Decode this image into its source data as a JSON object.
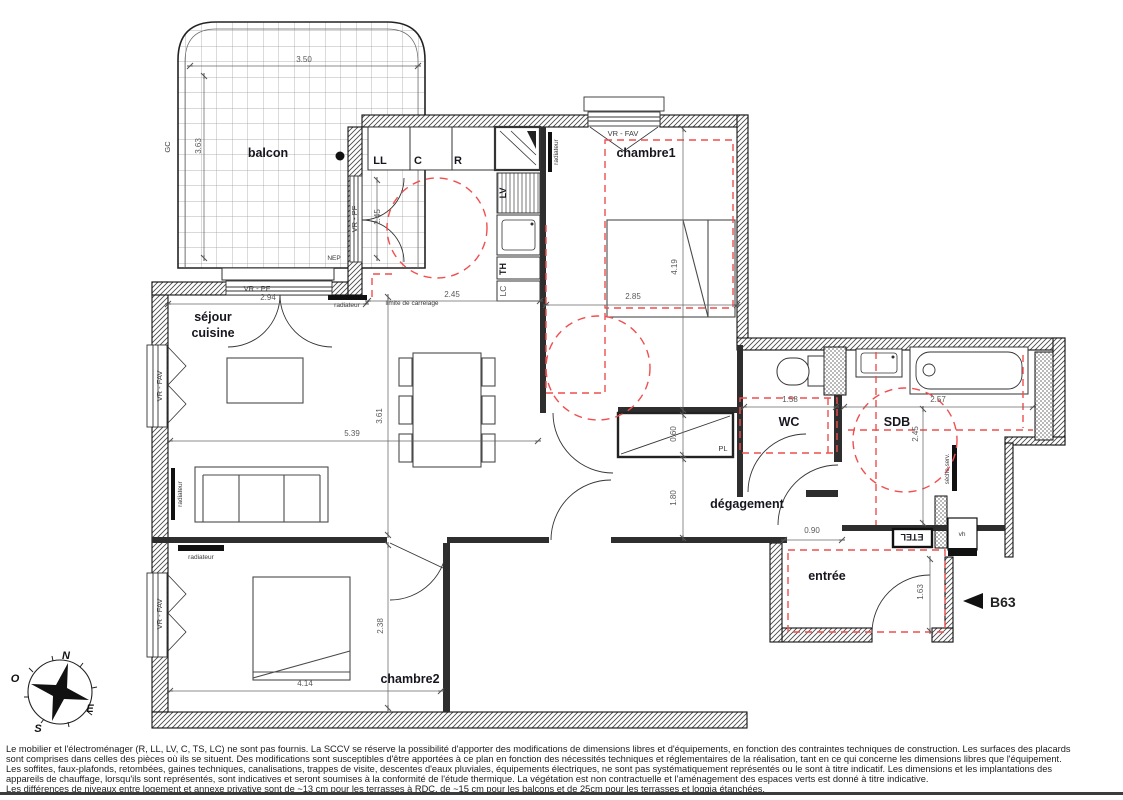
{
  "plan": {
    "rooms": {
      "balcon": "balcon",
      "sejour_line1": "séjour",
      "sejour_line2": "cuisine",
      "chambre1": "chambre1",
      "chambre2": "chambre2",
      "wc": "WC",
      "sdb": "SDB",
      "degagement": "dégagement",
      "entree": "entrée"
    },
    "labels": {
      "vr_pf": "VR - PF",
      "vr_fav": "VR - FAV",
      "radiateur": "radiateur",
      "limite_carrelage": "limite de carrelage",
      "nep": "NEP",
      "gc": "GC",
      "pl": "PL",
      "etel": "ETEL",
      "vh": "vh",
      "seche_serviettes": "sèche-serv.",
      "ll": "LL",
      "c": "C",
      "r": "R",
      "lv": "LV",
      "th": "TH",
      "lc": "LC"
    },
    "dimensions": {
      "balcon_width": "3.50",
      "balcon_depth": "3.63",
      "sejour_window": "2.94",
      "kitchen_bay": "2.45",
      "carrelage": "2.45",
      "chambre1_width": "2.85",
      "chambre1_length": "4.19",
      "placard_depth": "0.60",
      "degagement_length": "1.80",
      "sejour_width": "5.39",
      "sejour_depth": "3.61",
      "wc_width": "1.58",
      "sdb_width": "2.57",
      "sdb_depth": "2.45",
      "entree_passage": "0.90",
      "entree_depth": "1.63",
      "chambre2_depth": "2.38",
      "chambre2_width": "4.14"
    },
    "unit_ref": "B63",
    "compass": {
      "n": "N",
      "s": "S",
      "e": "E",
      "o": "O"
    }
  },
  "disclaimer": {
    "lines": [
      "Le mobilier et l'électroménager (R, LL, LV, C, TS, LC) ne sont pas fournis. La SCCV se réserve la possibilité d'apporter des modifications de dimensions libres et d'équipements, en fonction des contraintes techniques de construction. Les surfaces des placards",
      "sont comprises dans celles des pièces où ils se situent. Des modifications sont susceptibles d'être apportées à ce plan en fonction des nécessités techniques et réglementaires de la réalisation, tant en ce qui concerne les dimensions libres que l'équipement.",
      "Les soffites, faux-plafonds, retombées, gaines techniques, canalisations, trappes de visite, descentes d'eaux pluviales, équipements électriques, ne sont pas systématiquement représentés ou le sont à titre indicatif. Les dimensions et les implantations des",
      "appareils de chauffage, lorsqu'ils sont représentés, sont indicatives et seront soumises à la conformité de l'étude thermique. La végétation est non contractuelle et l'aménagement des espaces verts est donné à titre indicative.",
      "Les différences de niveaux entre logement et annexe privative sont de ~13 cm pour les terrasses à RDC, de ~15 cm pour les balcons et de 25cm pour les terrasses et loggia étanchées."
    ]
  }
}
